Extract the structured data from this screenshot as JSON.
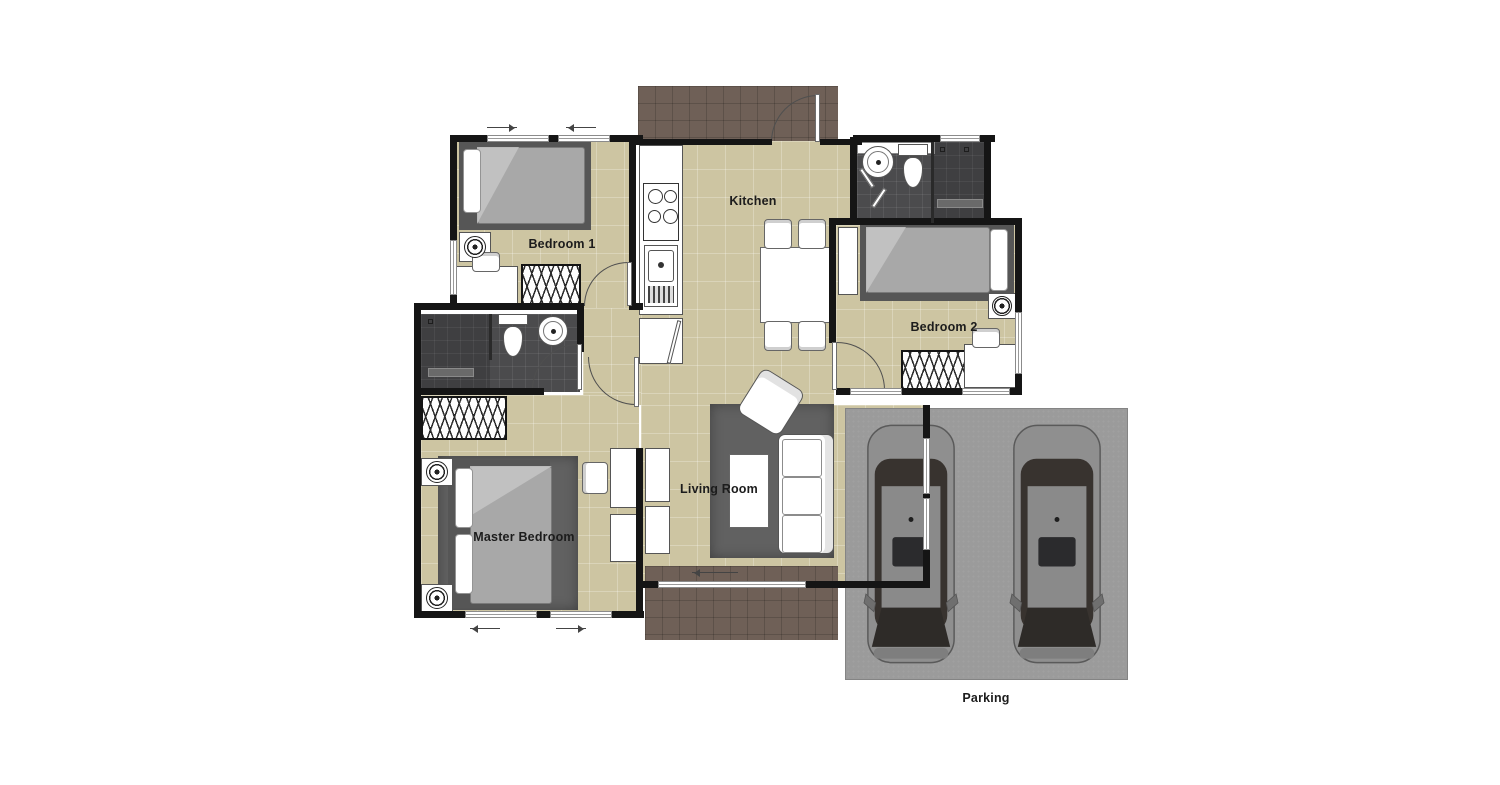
{
  "document": {
    "type": "floor-plan",
    "background": "#ffffff"
  },
  "rooms": {
    "bedroom1": {
      "label": "Bedroom 1"
    },
    "kitchen": {
      "label": "Kitchen"
    },
    "bedroom2": {
      "label": "Bedroom 2"
    },
    "master_bedroom": {
      "label": "Master Bedroom"
    },
    "living_room": {
      "label": "Living Room"
    },
    "parking": {
      "label": "Parking",
      "car_count": 2
    }
  },
  "colors": {
    "floor": "#cdc5a2",
    "wall": "#151515",
    "bath_tile": "#4b4b4d",
    "shower_tile": "#3f3f41",
    "porch_tile": "#6f6057",
    "rug": "#616161",
    "mattress": "#a8a8a8",
    "bed_base": "#565656",
    "parking_ground": "#9b9b9b",
    "car_body": "#8f8f8f",
    "car_glass": "#38332f"
  }
}
